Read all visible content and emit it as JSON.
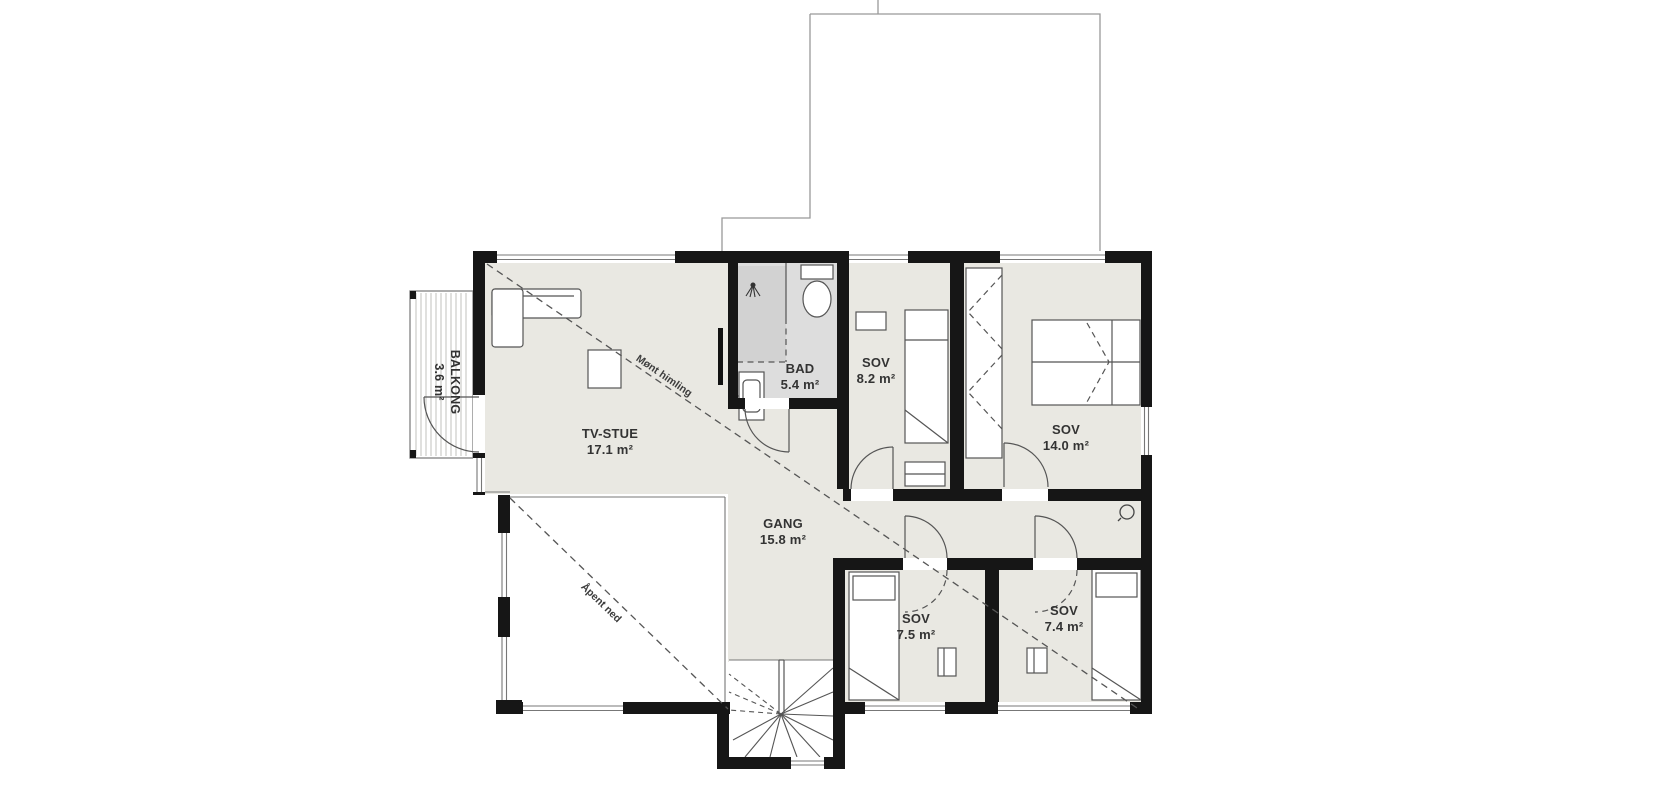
{
  "plan": {
    "title": "floor-plan-upper-level",
    "rooms": [
      {
        "id": "balkong",
        "name": "BALKONG",
        "area": "3.6 m²"
      },
      {
        "id": "tv-stue",
        "name": "TV-STUE",
        "area": "17.1 m²"
      },
      {
        "id": "bad",
        "name": "BAD",
        "area": "5.4 m²"
      },
      {
        "id": "sov-8",
        "name": "SOV",
        "area": "8.2 m²"
      },
      {
        "id": "sov-14",
        "name": "SOV",
        "area": "14.0 m²"
      },
      {
        "id": "gang",
        "name": "GANG",
        "area": "15.8 m²"
      },
      {
        "id": "sov-75",
        "name": "SOV",
        "area": "7.5 m²"
      },
      {
        "id": "sov-74",
        "name": "SOV",
        "area": "7.4 m²"
      }
    ],
    "annotations": [
      {
        "id": "ridge-ceiling",
        "text": "Mønt himling"
      },
      {
        "id": "open-below",
        "text": "Åpent ned"
      }
    ],
    "fixtures": [
      "shower-head-icon",
      "toilet-icon",
      "sink-icon",
      "staircase-icon",
      "bed-icon",
      "sofa-icon",
      "coffee-table-icon",
      "wardrobe-icon",
      "tv-icon",
      "ceiling-lamp-icon",
      "door-swing-icon",
      "window-icon"
    ],
    "colors": {
      "floor": "#e9e8e2",
      "bath_floor": "#dddddd",
      "shower": "#d2d2d2",
      "wall": "#161616",
      "line": "#555555",
      "background": "#ffffff"
    }
  }
}
